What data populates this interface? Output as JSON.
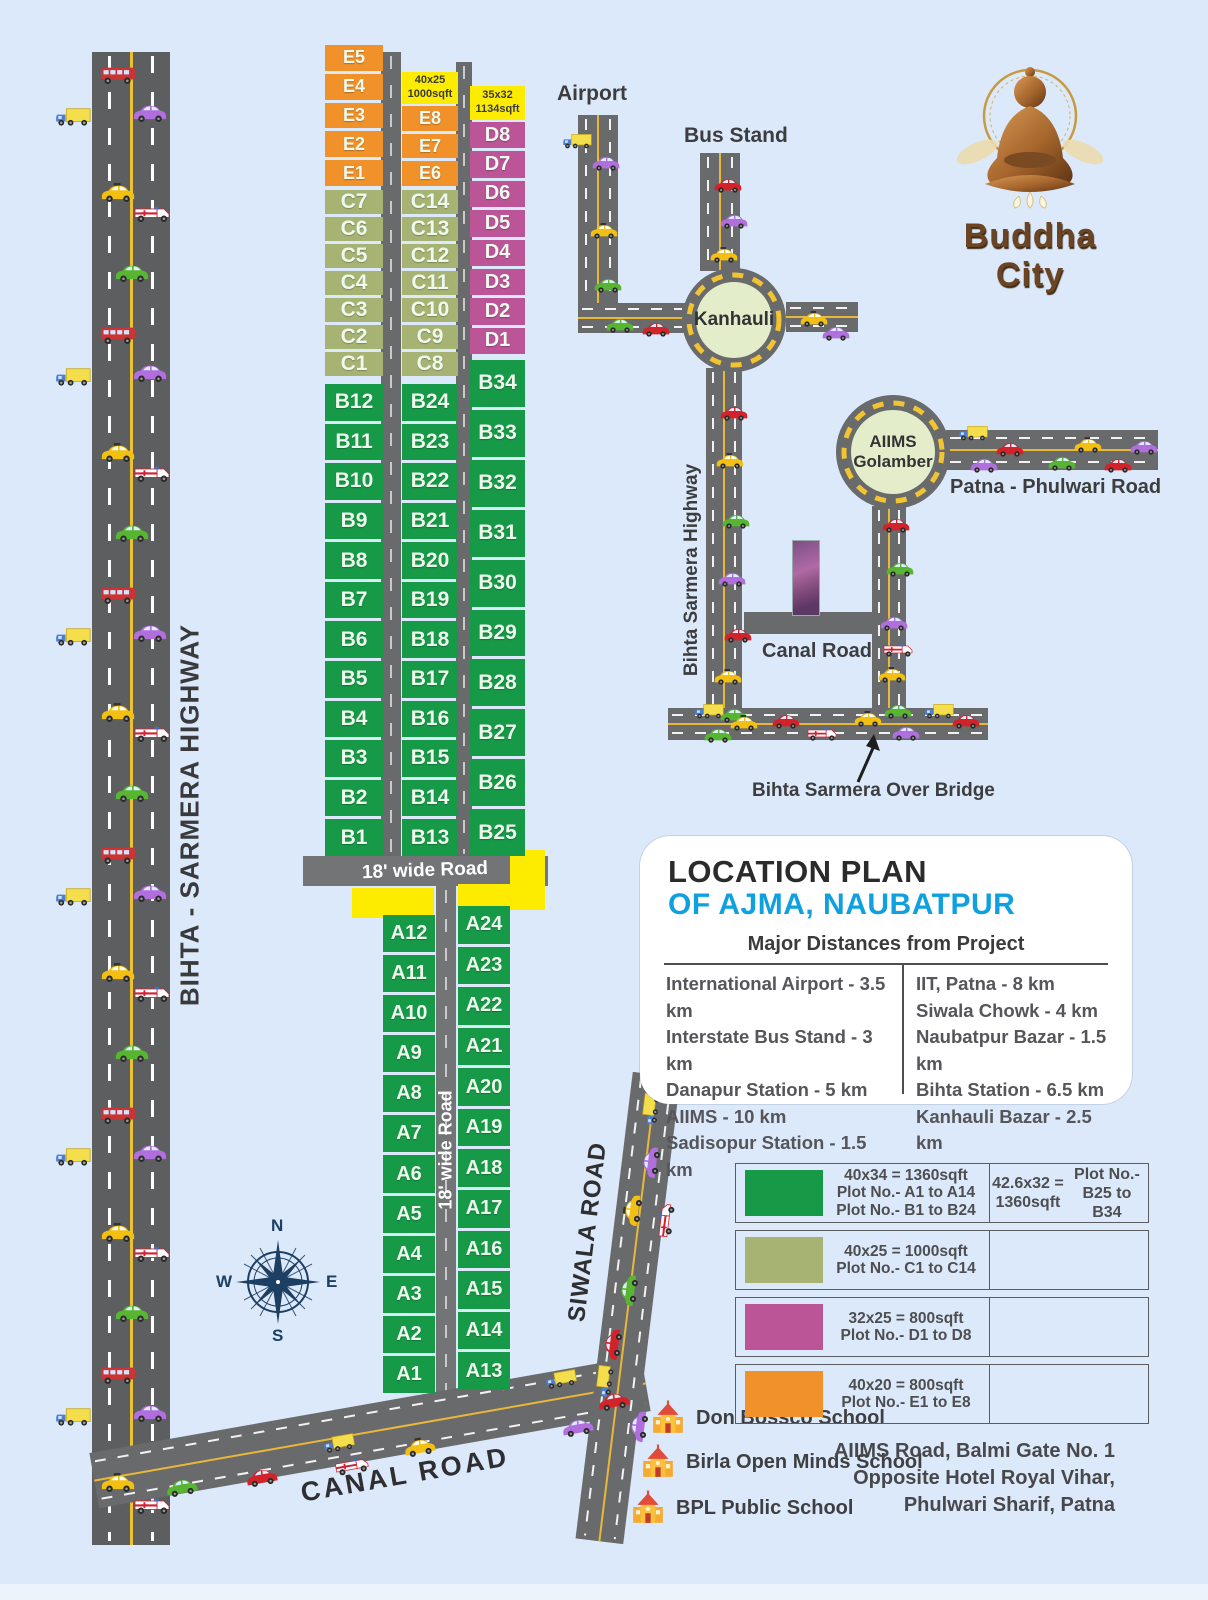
{
  "logo": {
    "brand": "Buddha City"
  },
  "labels": {
    "airport": "Airport",
    "bus_stand": "Bus Stand",
    "kanhauli": "Kanhauli",
    "aiims_golamber": "AIIMS\nGolamber",
    "patna_phulwari": "Patna - Phulwari Road",
    "bihta_sarmera_small": "Bihta Sarmera Highway",
    "canal_road_small": "Canal Road",
    "over_bridge": "Bihta Sarmera Over Bridge",
    "highway_big": "BIHTA - SARMERA HIGHWAY",
    "wide_road_h": "18' wide Road",
    "wide_road_v": "18' wide Road",
    "canal_road_big": "CANAL ROAD",
    "siwala_road": "SIWALA ROAD",
    "size_tag_mid": "40x25\n1000sqft",
    "size_tag_right": "35x32\n1134sqft"
  },
  "compass": {
    "n": "N",
    "e": "E",
    "s": "S",
    "w": "W"
  },
  "location_plan": {
    "title_black": "LOCATION PLAN",
    "title_blue": "OF AJMA, NAUBATPUR",
    "table_header": "Major Distances from Project",
    "left_column": [
      "International Airport - 3.5 km",
      "Interstate Bus Stand - 3 km",
      "Danapur Station - 5 km",
      "AIIMS - 10 km",
      "Sadisopur Station - 1.5 km"
    ],
    "right_column": [
      "IIT, Patna - 8 km",
      "Siwala Chowk - 4 km",
      "Naubatpur Bazar - 1.5 km",
      "Bihta Station - 6.5 km",
      "Kanhauli Bazar - 2.5 km"
    ]
  },
  "legend": {
    "rows": [
      {
        "color": "#169a47",
        "lines": [
          "40x34 = 1360sqft",
          "Plot No.- A1 to A14",
          "Plot No.- B1 to B24"
        ],
        "right": [
          "42.6x32 = 1360sqft",
          "Plot No.- B25 to B34"
        ]
      },
      {
        "color": "#a7b372",
        "lines": [
          "40x25 = 1000sqft",
          "Plot No.- C1 to C14"
        ],
        "right": []
      },
      {
        "color": "#bc5498",
        "lines": [
          "32x25 = 800sqft",
          "Plot No.- D1 to D8"
        ],
        "right": []
      },
      {
        "color": "#f0912a",
        "lines": [
          "40x20 = 800sqft",
          "Plot No.- E1 to E8"
        ],
        "right": []
      }
    ]
  },
  "schools": [
    "Don Bossco School",
    "Birla Open Minds School",
    "BPL Public School"
  ],
  "address_lines": [
    "AIIMS Road, Balmi Gate No. 1",
    "Opposite Hotel Royal Vihar,",
    "Phulwari Sharif, Patna"
  ],
  "plot_colors": {
    "A": "#169a47",
    "B": "#169a47",
    "C": "#a7b372",
    "D": "#bc5498",
    "E": "#f0912a"
  },
  "plots": {
    "e_left": [
      "E5",
      "E4",
      "E3",
      "E2",
      "E1"
    ],
    "c_left": [
      "C7",
      "C6",
      "C5",
      "C4",
      "C3",
      "C2",
      "C1"
    ],
    "b_left": [
      "B12",
      "B11",
      "B10",
      "B9",
      "B8",
      "B7",
      "B6",
      "B5",
      "B4",
      "B3",
      "B2",
      "B1"
    ],
    "e_mid": [
      "E8",
      "E7",
      "E6"
    ],
    "c_mid": [
      "C14",
      "C13",
      "C12",
      "C11",
      "C10",
      "C9",
      "C8"
    ],
    "b_mid": [
      "B24",
      "B23",
      "B22",
      "B21",
      "B20",
      "B19",
      "B18",
      "B17",
      "B16",
      "B15",
      "B14",
      "B13"
    ],
    "d_col": [
      "D8",
      "D7",
      "D6",
      "D5",
      "D4",
      "D3",
      "D2",
      "D1"
    ],
    "b_right": [
      "B34",
      "B33",
      "B32",
      "B31",
      "B30",
      "B29",
      "B28",
      "B27",
      "B26",
      "B25"
    ],
    "a_left": [
      "A12",
      "A11",
      "A10",
      "A9",
      "A8",
      "A7",
      "A6",
      "A5",
      "A4",
      "A3",
      "A2",
      "A1"
    ],
    "a_right": [
      "A24",
      "A23",
      "A22",
      "A21",
      "A20",
      "A19",
      "A18",
      "A17",
      "A16",
      "A15",
      "A14",
      "A13"
    ]
  },
  "traffic": [
    {
      "t": "bus",
      "x": 96,
      "y": 62
    },
    {
      "t": "truck",
      "x": 52,
      "y": 104
    },
    {
      "t": "car",
      "c": "#b06fdd",
      "x": 128,
      "y": 100
    },
    {
      "t": "taxi",
      "x": 96,
      "y": 180
    },
    {
      "t": "amb",
      "x": 130,
      "y": 200
    },
    {
      "t": "car",
      "c": "#58b531",
      "x": 110,
      "y": 260
    },
    {
      "t": "bus",
      "x": 96,
      "y": 322
    },
    {
      "t": "truck",
      "x": 52,
      "y": 364
    },
    {
      "t": "car",
      "c": "#b06fdd",
      "x": 128,
      "y": 360
    },
    {
      "t": "taxi",
      "x": 96,
      "y": 440
    },
    {
      "t": "amb",
      "x": 130,
      "y": 460
    },
    {
      "t": "car",
      "c": "#58b531",
      "x": 110,
      "y": 520
    },
    {
      "t": "bus",
      "x": 96,
      "y": 582
    },
    {
      "t": "truck",
      "x": 52,
      "y": 624
    },
    {
      "t": "car",
      "c": "#b06fdd",
      "x": 128,
      "y": 620
    },
    {
      "t": "taxi",
      "x": 96,
      "y": 700
    },
    {
      "t": "amb",
      "x": 130,
      "y": 720
    },
    {
      "t": "car",
      "c": "#58b531",
      "x": 110,
      "y": 780
    },
    {
      "t": "bus",
      "x": 96,
      "y": 842
    },
    {
      "t": "truck",
      "x": 52,
      "y": 884
    },
    {
      "t": "car",
      "c": "#b06fdd",
      "x": 128,
      "y": 880
    },
    {
      "t": "taxi",
      "x": 96,
      "y": 960
    },
    {
      "t": "amb",
      "x": 130,
      "y": 980
    },
    {
      "t": "car",
      "c": "#58b531",
      "x": 110,
      "y": 1040
    },
    {
      "t": "bus",
      "x": 96,
      "y": 1102
    },
    {
      "t": "truck",
      "x": 52,
      "y": 1144
    },
    {
      "t": "car",
      "c": "#b06fdd",
      "x": 128,
      "y": 1140
    },
    {
      "t": "taxi",
      "x": 96,
      "y": 1220
    },
    {
      "t": "amb",
      "x": 130,
      "y": 1240
    },
    {
      "t": "car",
      "c": "#58b531",
      "x": 110,
      "y": 1300
    },
    {
      "t": "bus",
      "x": 96,
      "y": 1362
    },
    {
      "t": "truck",
      "x": 52,
      "y": 1404
    },
    {
      "t": "car",
      "c": "#b06fdd",
      "x": 128,
      "y": 1400
    },
    {
      "t": "taxi",
      "x": 96,
      "y": 1470
    },
    {
      "t": "amb",
      "x": 130,
      "y": 1492
    },
    {
      "t": "car",
      "c": "#b06fdd",
      "x": 584,
      "y": 150,
      "s": 0.7
    },
    {
      "t": "taxi",
      "x": 582,
      "y": 218,
      "s": 0.7
    },
    {
      "t": "car",
      "c": "#58b531",
      "x": 586,
      "y": 272,
      "s": 0.7
    },
    {
      "t": "truck",
      "x": 556,
      "y": 128,
      "s": 0.7
    },
    {
      "t": "car",
      "c": "#d2232a",
      "x": 706,
      "y": 172,
      "s": 0.7
    },
    {
      "t": "car",
      "c": "#b06fdd",
      "x": 712,
      "y": 208,
      "s": 0.7
    },
    {
      "t": "taxi",
      "x": 702,
      "y": 242,
      "s": 0.7
    },
    {
      "t": "car",
      "c": "#58b531",
      "x": 598,
      "y": 312,
      "s": 0.7
    },
    {
      "t": "car",
      "c": "#d2232a",
      "x": 634,
      "y": 316,
      "s": 0.7
    },
    {
      "t": "taxi",
      "x": 792,
      "y": 306,
      "s": 0.7
    },
    {
      "t": "car",
      "c": "#b06fdd",
      "x": 814,
      "y": 320,
      "s": 0.7
    },
    {
      "t": "car",
      "c": "#d2232a",
      "x": 712,
      "y": 400,
      "s": 0.7
    },
    {
      "t": "taxi",
      "x": 708,
      "y": 448,
      "s": 0.7
    },
    {
      "t": "car",
      "c": "#58b531",
      "x": 714,
      "y": 508,
      "s": 0.7
    },
    {
      "t": "car",
      "c": "#b06fdd",
      "x": 710,
      "y": 566,
      "s": 0.7
    },
    {
      "t": "car",
      "c": "#d2232a",
      "x": 716,
      "y": 622,
      "s": 0.7
    },
    {
      "t": "taxi",
      "x": 706,
      "y": 664,
      "s": 0.7
    },
    {
      "t": "car",
      "c": "#58b531",
      "x": 712,
      "y": 702,
      "s": 0.7
    },
    {
      "t": "truck",
      "x": 952,
      "y": 420,
      "s": 0.7
    },
    {
      "t": "car",
      "c": "#d2232a",
      "x": 988,
      "y": 436,
      "s": 0.7
    },
    {
      "t": "car",
      "c": "#b06fdd",
      "x": 962,
      "y": 452,
      "s": 0.7
    },
    {
      "t": "car",
      "c": "#58b531",
      "x": 1040,
      "y": 450,
      "s": 0.7
    },
    {
      "t": "taxi",
      "x": 1066,
      "y": 432,
      "s": 0.7
    },
    {
      "t": "car",
      "c": "#d2232a",
      "x": 1096,
      "y": 452,
      "s": 0.7
    },
    {
      "t": "car",
      "c": "#b06fdd",
      "x": 1122,
      "y": 434,
      "s": 0.7
    },
    {
      "t": "car",
      "c": "#d2232a",
      "x": 874,
      "y": 512,
      "s": 0.7
    },
    {
      "t": "car",
      "c": "#58b531",
      "x": 878,
      "y": 556,
      "s": 0.7
    },
    {
      "t": "car",
      "c": "#b06fdd",
      "x": 872,
      "y": 610,
      "s": 0.7
    },
    {
      "t": "amb",
      "x": 876,
      "y": 636,
      "s": 0.7
    },
    {
      "t": "taxi",
      "x": 870,
      "y": 662,
      "s": 0.7
    },
    {
      "t": "car",
      "c": "#58b531",
      "x": 876,
      "y": 698,
      "s": 0.7
    },
    {
      "t": "truck",
      "x": 688,
      "y": 698,
      "s": 0.7
    },
    {
      "t": "taxi",
      "x": 722,
      "y": 710,
      "s": 0.7
    },
    {
      "t": "car",
      "c": "#58b531",
      "x": 696,
      "y": 722,
      "s": 0.7
    },
    {
      "t": "car",
      "c": "#d2232a",
      "x": 764,
      "y": 708,
      "s": 0.7
    },
    {
      "t": "amb",
      "x": 800,
      "y": 720,
      "s": 0.7
    },
    {
      "t": "taxi",
      "x": 846,
      "y": 706,
      "s": 0.7
    },
    {
      "t": "car",
      "c": "#b06fdd",
      "x": 884,
      "y": 720,
      "s": 0.7
    },
    {
      "t": "truck",
      "x": 918,
      "y": 698,
      "s": 0.7
    },
    {
      "t": "car",
      "c": "#d2232a",
      "x": 944,
      "y": 708,
      "s": 0.7
    },
    {
      "t": "car",
      "c": "#58b531",
      "x": 160,
      "y": 1474,
      "r": -10,
      "s": 0.8
    },
    {
      "t": "amb",
      "x": 330,
      "y": 1452,
      "r": -10,
      "s": 0.8
    },
    {
      "t": "taxi",
      "x": 398,
      "y": 1434,
      "r": -10,
      "s": 0.8
    },
    {
      "t": "car",
      "c": "#b06fdd",
      "x": 556,
      "y": 1414,
      "r": -10,
      "s": 0.8
    },
    {
      "t": "car",
      "c": "#d2232a",
      "x": 592,
      "y": 1388,
      "r": -10,
      "s": 0.8
    },
    {
      "t": "truck",
      "x": 540,
      "y": 1366,
      "r": -10,
      "s": 0.75
    },
    {
      "t": "car",
      "c": "#d2232a",
      "x": 240,
      "y": 1464,
      "r": -10,
      "s": 0.8
    },
    {
      "t": "truck",
      "x": 318,
      "y": 1430,
      "r": -10,
      "s": 0.75
    },
    {
      "t": "car",
      "c": "#b06fdd",
      "x": 630,
      "y": 1148,
      "r": -83,
      "s": 0.8
    },
    {
      "t": "taxi",
      "x": 612,
      "y": 1196,
      "r": -83,
      "s": 0.8
    },
    {
      "t": "amb",
      "x": 644,
      "y": 1206,
      "r": -83,
      "s": 0.8
    },
    {
      "t": "car",
      "c": "#58b531",
      "x": 608,
      "y": 1276,
      "r": -83,
      "s": 0.8
    },
    {
      "t": "car",
      "c": "#d2232a",
      "x": 592,
      "y": 1330,
      "r": -83,
      "s": 0.8
    },
    {
      "t": "truck",
      "x": 584,
      "y": 1366,
      "r": -83,
      "s": 0.75
    },
    {
      "t": "car",
      "c": "#b06fdd",
      "x": 618,
      "y": 1412,
      "r": -83,
      "s": 0.8
    },
    {
      "t": "truck",
      "x": 630,
      "y": 1094,
      "r": -83,
      "s": 0.75
    }
  ]
}
